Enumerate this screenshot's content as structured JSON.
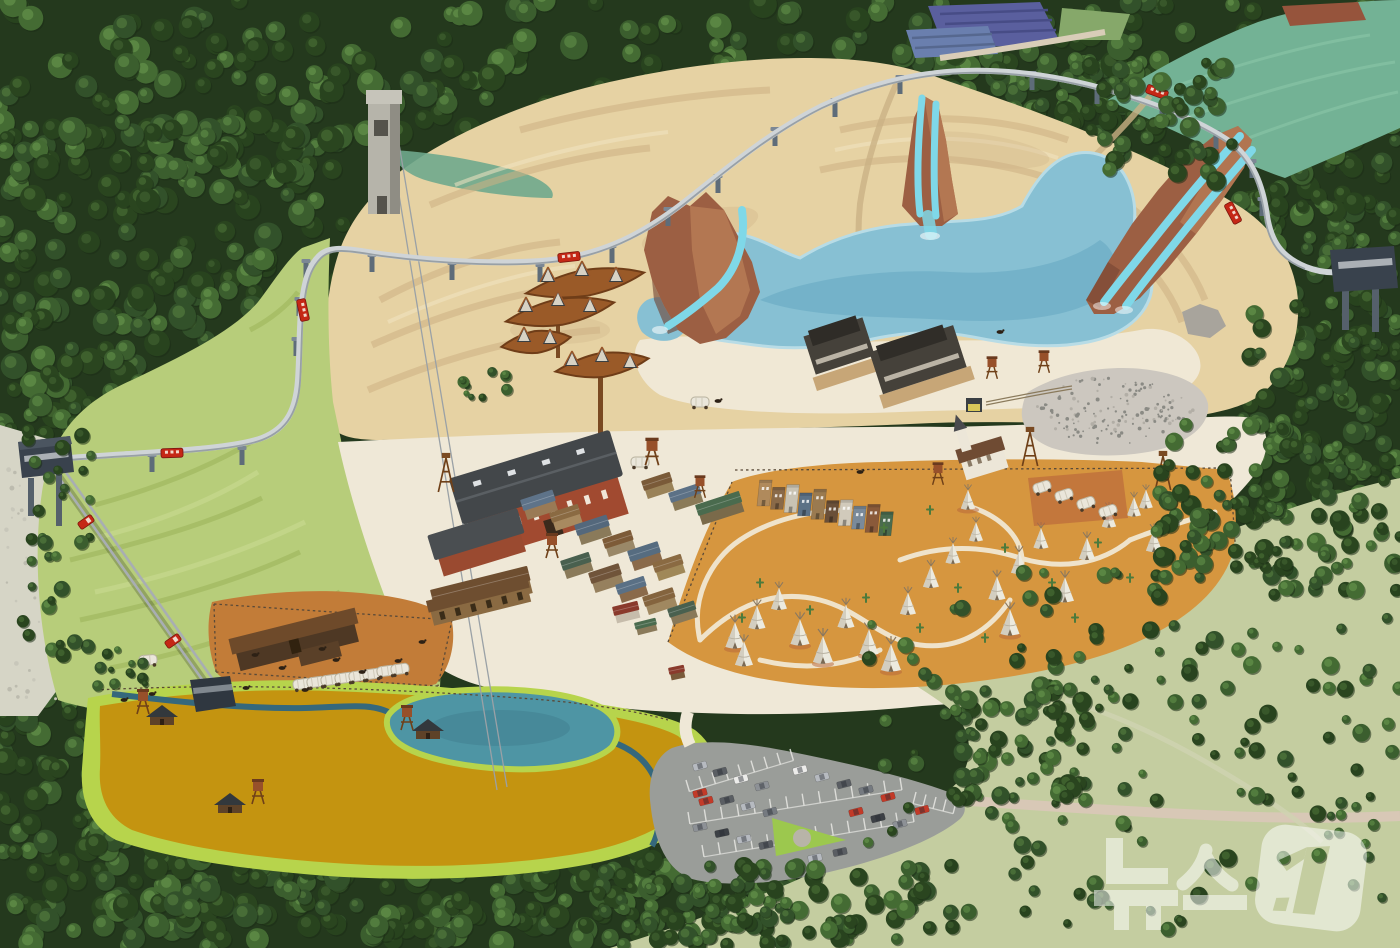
{
  "watermark": {
    "text": "뉴스1",
    "opacity": 0.52
  },
  "palette": {
    "forest_dark": "#24391d",
    "sand": "#e6d2a3",
    "sand_light": "#f1e4c1",
    "sand_shadow": "#cdb183",
    "beach": "#f0e9d8",
    "plaza": "#efe8d7",
    "lagoon": "#87c0d3",
    "lagoon_deep": "#5ea2bc",
    "slide": "#7fd8e8",
    "rock": "#9c5f43",
    "rock_light": "#bd8159",
    "rock_dark": "#6e4030",
    "grass": "#b7cd7a",
    "grass_dark": "#9fb75e",
    "scrub": "#c4cda0",
    "golden": "#c49410",
    "chartreuse": "#b7d44c",
    "pond": "#4e95a4",
    "stream": "#35687c",
    "dirt_orange": "#d6963f",
    "corral": "#c27c38",
    "path_white": "#f2ecdb",
    "parking": "#9a9d99",
    "road": "#d8c8b6",
    "track": "#cfd4d7",
    "pylon": "#5e6c79",
    "station": "#39424d",
    "brick": "#a14a30",
    "roof_dark": "#43474a",
    "wood": "#7a4a26",
    "rust": "#99572a",
    "marsh": "#73b295",
    "field_purple": "#5a5f9e",
    "field_blue": "#6a7fae",
    "red_vehicle": "#c52716",
    "teepee": "#eceadf",
    "gravel": "#ccc7bf",
    "scree": "#d6d5c6",
    "white": "#ffffff"
  },
  "forest": {
    "colors": [
      [
        "#2a451f",
        "#40632f"
      ],
      [
        "#32512a",
        "#4a7038"
      ],
      [
        "#3b5e2e",
        "#558040"
      ],
      [
        "#28431e",
        "#3a5a2b"
      ],
      [
        "#446b33",
        "#5d8a45"
      ]
    ],
    "under": [
      [
        0,
        0,
        1400,
        150,
        280,
        7,
        14
      ],
      [
        0,
        120,
        345,
        330,
        220,
        7,
        14
      ],
      [
        900,
        50,
        280,
        145,
        90,
        6,
        12
      ],
      [
        1048,
        115,
        352,
        130,
        90,
        6,
        12
      ],
      [
        1240,
        195,
        160,
        395,
        150,
        6,
        12
      ],
      [
        0,
        368,
        95,
        355,
        70,
        6,
        11
      ],
      [
        0,
        665,
        195,
        283,
        130,
        7,
        13
      ],
      [
        95,
        812,
        830,
        136,
        280,
        7,
        13
      ]
    ],
    "over": [
      [
        860,
        572,
        540,
        360,
        160,
        4,
        9
      ],
      [
        598,
        866,
        335,
        80,
        85,
        5,
        10
      ],
      [
        952,
        686,
        145,
        118,
        60,
        5,
        10
      ],
      [
        1152,
        422,
        145,
        155,
        75,
        5,
        10
      ],
      [
        1250,
        295,
        150,
        295,
        75,
        5,
        10
      ],
      [
        1075,
        58,
        160,
        125,
        50,
        5,
        10
      ],
      [
        22,
        428,
        75,
        265,
        32,
        4,
        8
      ],
      [
        450,
        368,
        58,
        32,
        10,
        3,
        6
      ],
      [
        90,
        645,
        65,
        42,
        12,
        3,
        6
      ],
      [
        695,
        882,
        100,
        62,
        32,
        5,
        9
      ]
    ]
  },
  "teepees": [
    [
      735,
      645,
      0.95
    ],
    [
      757,
      626,
      0.85
    ],
    [
      779,
      607,
      0.8
    ],
    [
      744,
      663,
      0.9
    ],
    [
      800,
      642,
      0.95
    ],
    [
      823,
      660,
      1.0
    ],
    [
      846,
      625,
      0.85
    ],
    [
      869,
      652,
      0.95
    ],
    [
      891,
      668,
      1.0
    ],
    [
      908,
      612,
      0.8
    ],
    [
      931,
      585,
      0.8
    ],
    [
      953,
      561,
      0.75
    ],
    [
      976,
      539,
      0.7
    ],
    [
      997,
      597,
      0.85
    ],
    [
      1019,
      571,
      0.8
    ],
    [
      1041,
      546,
      0.75
    ],
    [
      1065,
      599,
      0.9
    ],
    [
      1087,
      557,
      0.8
    ],
    [
      1109,
      525,
      0.72
    ],
    [
      1134,
      514,
      0.7
    ],
    [
      1154,
      549,
      0.8
    ],
    [
      1010,
      632,
      0.95
    ],
    [
      968,
      507,
      0.72
    ],
    [
      1146,
      506,
      0.68
    ]
  ],
  "teepee_pads": [
    [
      735,
      649
    ],
    [
      800,
      646
    ],
    [
      823,
      664
    ],
    [
      869,
      656
    ],
    [
      891,
      672
    ],
    [
      1010,
      636
    ],
    [
      968,
      510
    ]
  ],
  "cacti": [
    [
      760,
      585
    ],
    [
      810,
      612
    ],
    [
      866,
      600
    ],
    [
      920,
      630
    ],
    [
      958,
      590
    ],
    [
      1005,
      550
    ],
    [
      1052,
      585
    ],
    [
      1098,
      545
    ],
    [
      1130,
      580
    ],
    [
      1168,
      530
    ],
    [
      742,
      620
    ],
    [
      884,
      530
    ],
    [
      930,
      512
    ],
    [
      1075,
      620
    ],
    [
      985,
      640
    ]
  ],
  "horses": [
    [
      718,
      401
    ],
    [
      860,
      472
    ],
    [
      1000,
      332
    ],
    [
      255,
      655
    ],
    [
      282,
      668
    ],
    [
      322,
      649
    ],
    [
      362,
      672
    ],
    [
      398,
      661
    ],
    [
      422,
      642
    ],
    [
      246,
      688
    ],
    [
      305,
      690
    ],
    [
      336,
      660
    ],
    [
      124,
      700
    ],
    [
      152,
      694
    ]
  ],
  "pylons": [
    [
      152,
      456
    ],
    [
      242,
      449
    ],
    [
      296,
      340
    ],
    [
      299,
      300
    ],
    [
      306,
      262
    ],
    [
      372,
      256
    ],
    [
      452,
      264
    ],
    [
      540,
      266
    ],
    [
      612,
      247
    ],
    [
      668,
      210
    ],
    [
      718,
      177
    ],
    [
      775,
      130
    ],
    [
      835,
      101
    ],
    [
      900,
      78
    ],
    [
      1032,
      74
    ],
    [
      1097,
      88
    ],
    [
      1162,
      107
    ],
    [
      1216,
      133
    ],
    [
      1252,
      162
    ],
    [
      1262,
      200
    ]
  ],
  "trains": [
    [
      172,
      453,
      -2
    ],
    [
      303,
      310,
      78
    ],
    [
      569,
      257,
      -6
    ],
    [
      1157,
      92,
      20
    ],
    [
      1233,
      213,
      62
    ]
  ],
  "funicular_cars": [
    [
      86,
      522,
      55
    ],
    [
      173,
      641,
      55
    ]
  ],
  "wagons": {
    "row": [
      [
        302,
        684,
        -8
      ],
      [
        316,
        682,
        -8
      ],
      [
        330,
        680,
        -8
      ],
      [
        344,
        678,
        -8
      ],
      [
        358,
        676,
        -8
      ],
      [
        372,
        674,
        -8
      ],
      [
        386,
        671,
        -8
      ],
      [
        400,
        669,
        -8
      ]
    ],
    "pad": [
      [
        1042,
        487,
        -18
      ],
      [
        1064,
        495,
        -18
      ],
      [
        1086,
        503,
        -18
      ],
      [
        1108,
        511,
        -18
      ]
    ],
    "single": [
      [
        148,
        660,
        -5
      ],
      [
        700,
        402,
        0
      ],
      [
        640,
        462,
        0
      ]
    ]
  },
  "watertowers": [
    [
      143,
      702,
      1
    ],
    [
      407,
      718,
      1
    ],
    [
      258,
      792,
      1
    ],
    [
      652,
      452,
      1.1
    ],
    [
      552,
      546,
      1
    ],
    [
      992,
      368,
      0.9
    ],
    [
      1044,
      362,
      0.9
    ],
    [
      700,
      487,
      0.9
    ],
    [
      938,
      474,
      0.9
    ]
  ],
  "derricks": [
    [
      1030,
      466
    ],
    [
      1163,
      490
    ],
    [
      446,
      492
    ]
  ],
  "cabins": [
    [
      162,
      714
    ],
    [
      428,
      728
    ],
    [
      230,
      802
    ]
  ],
  "cars": {
    "colors": [
      "#b6bac0",
      "#8d9196",
      "#5a5e63",
      "#c33a28",
      "#ececea",
      "#3c4045",
      "#757a80"
    ],
    "items": [
      [
        700,
        766,
        -15,
        0
      ],
      [
        720,
        772,
        -15,
        2
      ],
      [
        741,
        779,
        -15,
        4
      ],
      [
        762,
        786,
        -15,
        1
      ],
      [
        700,
        793,
        -15,
        3
      ],
      [
        706,
        801,
        -15,
        3
      ],
      [
        727,
        800,
        -15,
        2
      ],
      [
        748,
        806,
        -15,
        0
      ],
      [
        770,
        812,
        -15,
        6
      ],
      [
        700,
        827,
        -12,
        1
      ],
      [
        722,
        833,
        -12,
        5
      ],
      [
        744,
        839,
        -12,
        0
      ],
      [
        766,
        845,
        -12,
        2
      ],
      [
        800,
        770,
        -15,
        4
      ],
      [
        822,
        777,
        -15,
        0
      ],
      [
        844,
        784,
        -15,
        2
      ],
      [
        866,
        790,
        -15,
        6
      ],
      [
        888,
        797,
        -15,
        3
      ],
      [
        856,
        812,
        -15,
        3
      ],
      [
        878,
        818,
        -15,
        5
      ],
      [
        900,
        824,
        -15,
        1
      ],
      [
        922,
        810,
        -15,
        3
      ],
      [
        840,
        852,
        -12,
        2
      ],
      [
        815,
        858,
        -12,
        0
      ]
    ]
  },
  "town_buildings": [
    [
      520,
      500,
      34,
      20,
      -18,
      "#5e7389",
      "#9a7a55"
    ],
    [
      549,
      513,
      30,
      18,
      -18,
      "#8a6a42",
      "#a88a60"
    ],
    [
      574,
      525,
      34,
      20,
      -18,
      "#54687c",
      "#8a7a5a"
    ],
    [
      602,
      539,
      30,
      18,
      -18,
      "#7d5b38",
      "#9a8868"
    ],
    [
      627,
      551,
      32,
      20,
      -18,
      "#566c80",
      "#8a6a4a"
    ],
    [
      652,
      563,
      30,
      18,
      -18,
      "#8a6a42",
      "#a08858"
    ],
    [
      560,
      561,
      30,
      18,
      -18,
      "#49604f",
      "#8a7a5a"
    ],
    [
      588,
      573,
      32,
      20,
      -18,
      "#70543a",
      "#96805e"
    ],
    [
      615,
      585,
      30,
      18,
      -18,
      "#5a7085",
      "#8a6a4a"
    ],
    [
      642,
      597,
      32,
      18,
      -18,
      "#84643e",
      "#a08860"
    ],
    [
      667,
      609,
      28,
      16,
      -18,
      "#49604f",
      "#887858"
    ],
    [
      641,
      481,
      30,
      18,
      -18,
      "#7a5a38",
      "#9a8258"
    ],
    [
      668,
      493,
      32,
      18,
      -18,
      "#5c7186",
      "#8a7a58"
    ],
    [
      695,
      505,
      46,
      20,
      -18,
      "#4a6b4e",
      "#7a6a4a"
    ],
    [
      612,
      607,
      26,
      16,
      -14,
      "#8a3a2c",
      "#c6bcab"
    ],
    [
      634,
      623,
      22,
      12,
      -14,
      "#4a6b4e",
      "#8a7a5a"
    ],
    [
      668,
      668,
      16,
      12,
      -12,
      "#8a3a2c",
      "#7a5a3a"
    ],
    [
      430,
      590,
      100,
      26,
      -14,
      "#6e4e30",
      "#8a6a42"
    ]
  ],
  "storefronts": {
    "x": 757,
    "y": 506,
    "dx": 13.5,
    "dy": 3.3,
    "heights": [
      26,
      22,
      28,
      23,
      30,
      22,
      26,
      23,
      28,
      24
    ],
    "colors": [
      "#b08a5c",
      "#8a6a48",
      "#c9c3b3",
      "#5c7186",
      "#9a7a50",
      "#6a4f38",
      "#d1cabb",
      "#7a8a9a",
      "#8a5a3a",
      "#4a6b4e"
    ]
  },
  "parking_ticks": [
    [
      686,
      780,
      790,
      749,
      8
    ],
    [
      688,
      812,
      900,
      778,
      13
    ],
    [
      702,
      845,
      912,
      810,
      13
    ],
    [
      916,
      792,
      956,
      802,
      4
    ]
  ],
  "gravel_dots": {
    "cx": 1115,
    "cy": 410,
    "rx": 80,
    "ry": 34,
    "n": 150
  },
  "scree_dots": {
    "x": 4,
    "y": 432,
    "w": 58,
    "h": 276,
    "n": 45
  }
}
